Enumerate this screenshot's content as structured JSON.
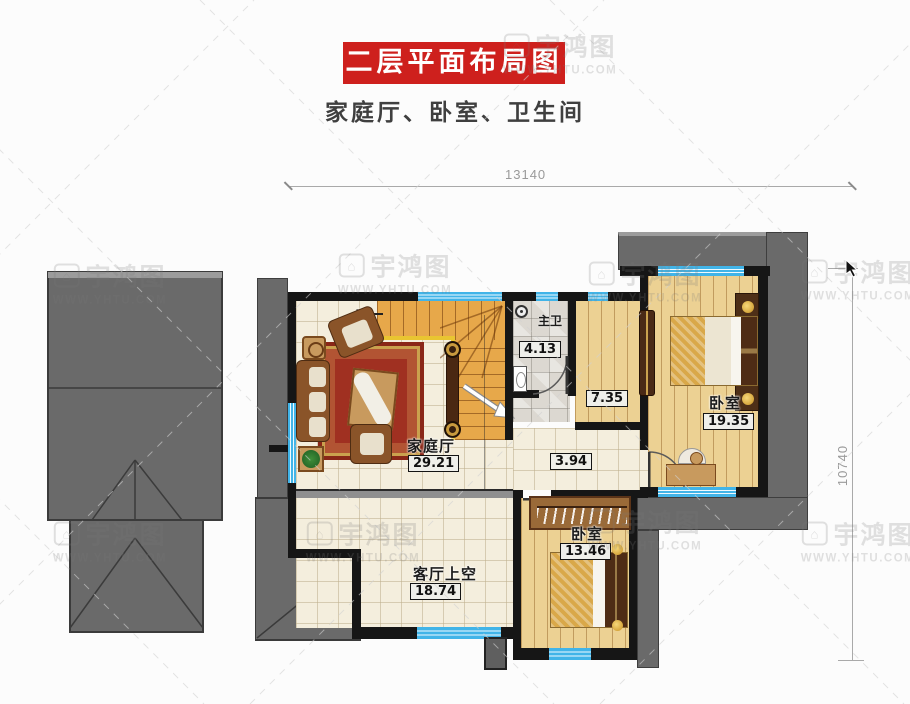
{
  "header": {
    "banner_title": "二层平面布局图",
    "subtitle": "家庭厅、卧室、卫生间"
  },
  "dimensions": {
    "width_mm": "13140",
    "height_mm": "10740"
  },
  "rooms": {
    "family_hall": {
      "label": "家庭厅",
      "area": "29.21"
    },
    "master_bath": {
      "label": "主卫",
      "area": "4.13"
    },
    "corridor": {
      "area": "7.35"
    },
    "hallway": {
      "area": "3.94"
    },
    "bedroom_right": {
      "label": "卧室",
      "area": "19.35"
    },
    "bedroom_bottom": {
      "label": "卧室",
      "area": "13.46"
    },
    "living_void": {
      "label": "客厅上空",
      "area": "18.74"
    }
  },
  "stairs": {
    "down_label": "下"
  },
  "watermark": {
    "brand": "宇鸿图",
    "site": "WWW.YHTU.COM"
  },
  "colors": {
    "banner_red": "#ce201d",
    "wall": "#161616",
    "window_cyan": "#41b4e8",
    "roof_gray": "#6a6a6a"
  }
}
